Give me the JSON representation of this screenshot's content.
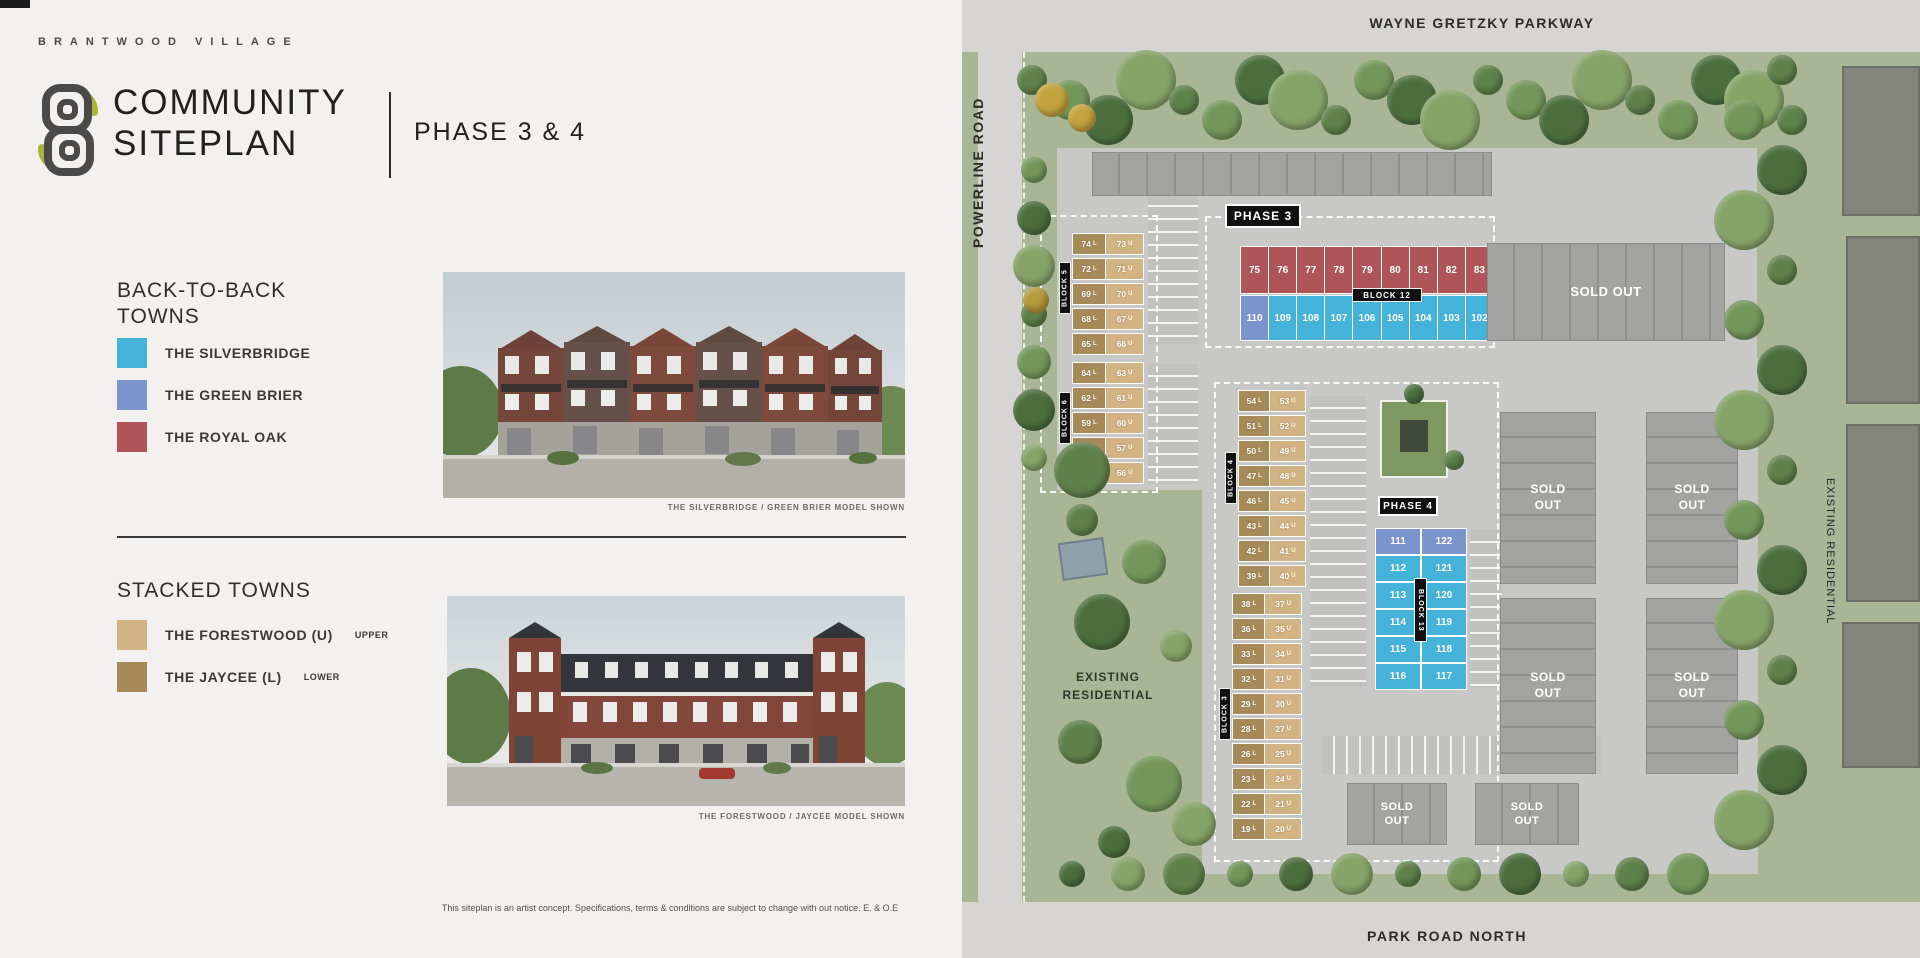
{
  "header": {
    "brand": "BRANTWOOD VILLAGE",
    "title_line1": "COMMUNITY",
    "title_line2": "SITEPLAN",
    "phase": "PHASE 3 & 4"
  },
  "legend": {
    "back_to_back": {
      "heading_line1": "BACK-TO-BACK",
      "heading_line2": "TOWNS",
      "items": [
        {
          "label": "THE SILVERBRIDGE",
          "color": "#45b3d9"
        },
        {
          "label": "THE GREEN BRIER",
          "color": "#7b94cc"
        },
        {
          "label": "THE ROYAL OAK",
          "color": "#b05557"
        }
      ],
      "caption": "THE SILVERBRIDGE / GREEN BRIER MODEL SHOWN"
    },
    "stacked": {
      "heading": "STACKED TOWNS",
      "items": [
        {
          "label": "THE FORESTWOOD (U)",
          "suffix": "UPPER",
          "color": "#d2b384"
        },
        {
          "label": "THE JAYCEE (L)",
          "suffix": "LOWER",
          "color": "#a68a58"
        }
      ],
      "caption": "THE FORESTWOOD / JAYCEE MODEL SHOWN"
    }
  },
  "disclaimer": "This siteplan is an artist concept. Specifications, terms & conditions are subject to change with out notice. E. & O.E",
  "map": {
    "roads": {
      "top": "WAYNE GRETZKY PARKWAY",
      "left": "POWERLINE ROAD",
      "bottom": "PARK ROAD NORTH"
    },
    "existing_residential_left_line1": "EXISTING",
    "existing_residential_left_line2": "RESIDENTIAL",
    "existing_residential_right": "EXISTING RESIDENTIAL",
    "sold_out": "SOLD OUT",
    "phase3_label": "PHASE 3",
    "phase4_label": "PHASE 4",
    "colors": {
      "silverbridge": "#45b3d9",
      "greenbrier": "#7b94cc",
      "royaloak": "#b05557",
      "forestwood": "#d2b384",
      "jaycee": "#a68a58"
    },
    "blocks": {
      "block5": {
        "label": "BLOCK 5",
        "rows": [
          [
            "74 L",
            "73 U"
          ],
          [
            "72 L",
            "71 U"
          ],
          [
            "69 L",
            "70 U"
          ],
          [
            "68 L",
            "67 U"
          ],
          [
            "65 L",
            "66 U"
          ]
        ]
      },
      "block6": {
        "label": "BLOCK 6",
        "rows": [
          [
            "64 L",
            "63 U"
          ],
          [
            "62 L",
            "61 U"
          ],
          [
            "59 L",
            "60 U"
          ],
          [
            "58 L",
            "57 U"
          ],
          [
            "55 L",
            "56 U"
          ]
        ]
      },
      "block4": {
        "label": "BLOCK 4",
        "rows": [
          [
            "54 L",
            "53 U"
          ],
          [
            "51 L",
            "52 U"
          ],
          [
            "50 L",
            "49 U"
          ],
          [
            "47 L",
            "48 U"
          ],
          [
            "46 L",
            "45 U"
          ],
          [
            "43 L",
            "44 U"
          ],
          [
            "42 L",
            "41 U"
          ],
          [
            "39 L",
            "40 U"
          ]
        ]
      },
      "block3": {
        "label": "BLOCK 3",
        "rows": [
          [
            "38 L",
            "37 U"
          ],
          [
            "36 L",
            "35 U"
          ],
          [
            "33 L",
            "34 U"
          ],
          [
            "32 L",
            "31 U"
          ],
          [
            "29 L",
            "30 U"
          ],
          [
            "28 L",
            "27 U"
          ],
          [
            "26 L",
            "25 U"
          ],
          [
            "23 L",
            "24 U"
          ],
          [
            "22 L",
            "21 U"
          ],
          [
            "19 L",
            "20 U"
          ]
        ]
      },
      "block12": {
        "label": "BLOCK 12",
        "red_row": [
          "75",
          "76",
          "77",
          "78",
          "79",
          "80",
          "81",
          "82",
          "83"
        ],
        "blue_row": [
          "110",
          "109",
          "108",
          "107",
          "106",
          "105",
          "104",
          "103",
          "102"
        ],
        "blue_row_greenbrier_units": [
          "110"
        ]
      },
      "block13": {
        "label": "BLOCK 13",
        "rows": [
          [
            "111",
            "122"
          ],
          [
            "112",
            "121"
          ],
          [
            "113",
            "120"
          ],
          [
            "114",
            "119"
          ],
          [
            "115",
            "118"
          ],
          [
            "116",
            "117"
          ]
        ],
        "greenbrier_rows": [
          0
        ]
      }
    }
  }
}
